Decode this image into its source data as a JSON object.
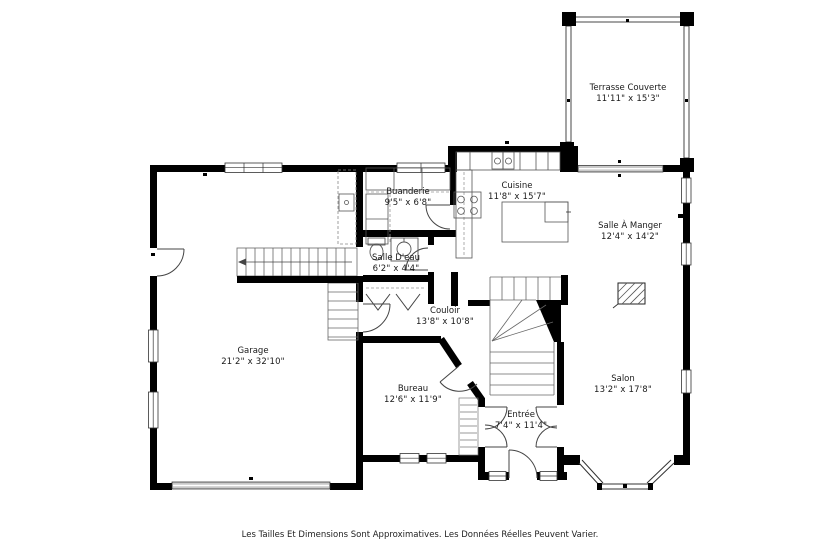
{
  "plan": {
    "disclaimer": "Les Tailles Et Dimensions Sont Approximatives. Les Données Réelles Peuvent Varier.",
    "rooms": [
      {
        "id": "terrasse",
        "name": "Terrasse Couverte",
        "dims": "11'11\" x 15'3\"",
        "cx": 628,
        "cy": 94
      },
      {
        "id": "cuisine",
        "name": "Cuisine",
        "dims": "11'8\" x 15'7\"",
        "cx": 517,
        "cy": 192
      },
      {
        "id": "buanderie",
        "name": "Buanderie",
        "dims": "9'5\" x 6'8\"",
        "cx": 408,
        "cy": 198
      },
      {
        "id": "salle-a-manger",
        "name": "Salle À Manger",
        "dims": "12'4\" x 14'2\"",
        "cx": 630,
        "cy": 232
      },
      {
        "id": "salle-deau",
        "name": "Salle D'eau",
        "dims": "6'2\" x 4'4\"",
        "cx": 396,
        "cy": 264
      },
      {
        "id": "couloir",
        "name": "Couloir",
        "dims": "13'8\" x 10'8\"",
        "cx": 445,
        "cy": 317
      },
      {
        "id": "garage",
        "name": "Garage",
        "dims": "21'2\" x 32'10\"",
        "cx": 253,
        "cy": 357
      },
      {
        "id": "bureau",
        "name": "Bureau",
        "dims": "12'6\" x 11'9\"",
        "cx": 413,
        "cy": 395
      },
      {
        "id": "entree",
        "name": "Entrée",
        "dims": "7'4\" x 11'4\"",
        "cx": 521,
        "cy": 421
      },
      {
        "id": "salon",
        "name": "Salon",
        "dims": "13'2\" x 17'8\"",
        "cx": 623,
        "cy": 385
      }
    ],
    "colors": {
      "wall": "#000000",
      "thin_line": "#444444",
      "window_fill": "#ffffff",
      "door_band": "#c9c9c9",
      "text": "#1a1a1a",
      "background": "#ffffff"
    }
  }
}
